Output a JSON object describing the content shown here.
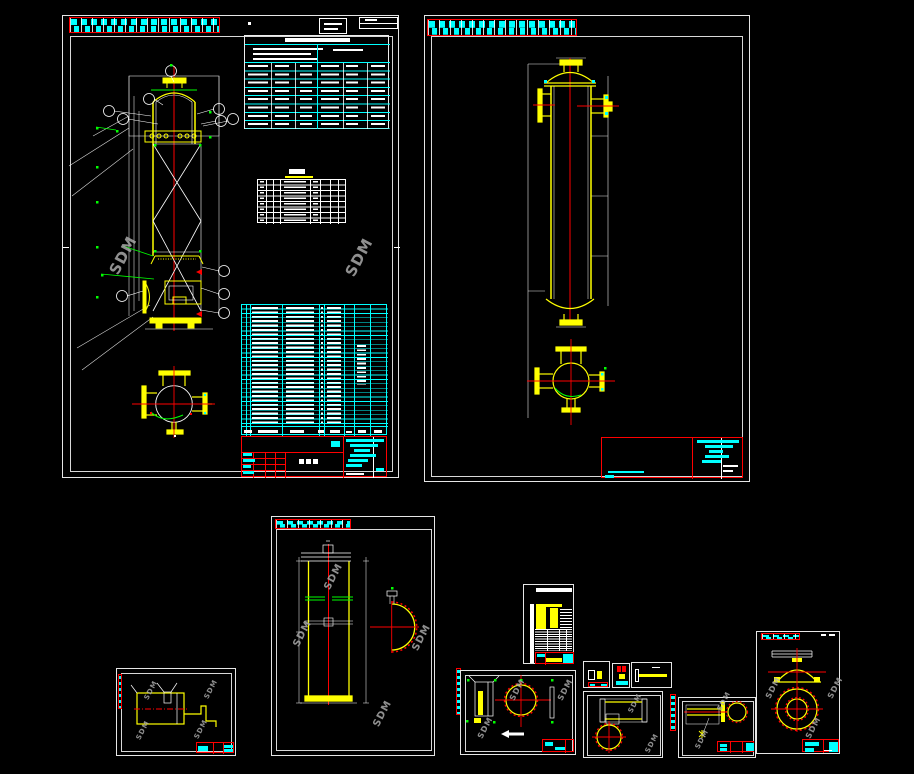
{
  "canvas": {
    "background": "#000000",
    "width": 914,
    "height": 774,
    "kind": "CAD drawing workspace"
  },
  "palette": {
    "frame_white": "#ffffff",
    "part_yellow": "#ffff00",
    "centerline_red": "#ff0000",
    "table_cyan": "#00ffff",
    "weld_green": "#00ff00",
    "watermark_gray": "#a9a9a9"
  },
  "watermark": {
    "label": "SDM"
  },
  "sheets": [
    {
      "id": "assembly-drawing"
    },
    {
      "id": "vessel-elevation-drawing"
    },
    {
      "id": "shell-detail-drawing"
    },
    {
      "id": "bracket-detail-drawing"
    },
    {
      "id": "parts-table-card"
    },
    {
      "id": "flange-detail-drawing"
    },
    {
      "id": "detail-card-a"
    },
    {
      "id": "detail-card-b"
    },
    {
      "id": "detail-card-c"
    },
    {
      "id": "sleeve-detail-drawing"
    },
    {
      "id": "nozzle-detail-drawing"
    },
    {
      "id": "head-detail-drawing"
    }
  ],
  "tables": {
    "bom_rows": 27,
    "spec_rows": 8,
    "nozzle_rows": 8
  }
}
